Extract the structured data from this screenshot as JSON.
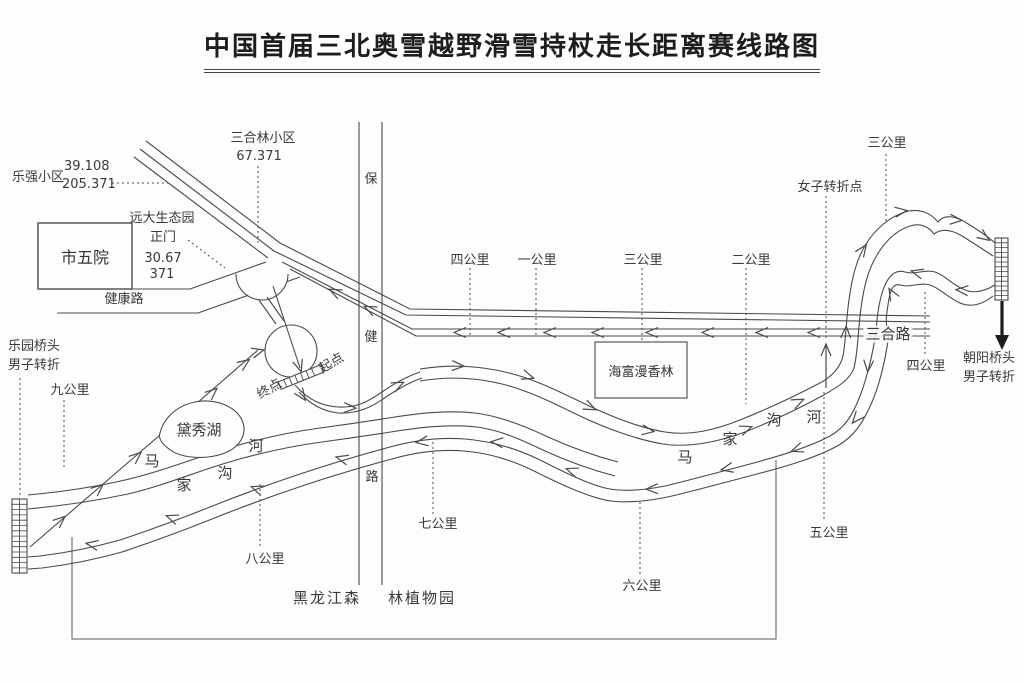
{
  "title": "中国首届三北奥雪越野滑雪持杖走长距离赛线路图",
  "labels": {
    "leqiang_name": "乐强小区",
    "leqiang_num1": "39.108",
    "leqiang_num2": "205.371",
    "sanhelin_name": "三合林小区",
    "sanhelin_num": "67.371",
    "yuanda_line1": "远大生态园",
    "yuanda_line2": "正门",
    "yuanda_num1": "30.67",
    "yuanda_num2": "371",
    "shiwuyuan": "市五院",
    "jiankang_road": "健康路",
    "baojian_bao": "保",
    "baojian_jian": "健",
    "baojian_lu": "路",
    "km4_top": "四公里",
    "km1_top": "一公里",
    "km3_top": "三公里",
    "km2_top": "二公里",
    "haifu": "海富漫香林",
    "nvzi_turn": "女子转折点",
    "km3_right": "三公里",
    "sanhe_road": "三合路",
    "km4_right": "四公里",
    "chaoyang_line1": "朝阳桥头",
    "chaoyang_line2": "男子转折",
    "leyuan_line1": "乐园桥头",
    "leyuan_line2": "男子转折",
    "km9": "九公里",
    "daixiu_lake": "黛秀湖",
    "river_left_1": "马",
    "river_left_2": "家",
    "river_left_3": "沟",
    "river_left_4": "河",
    "river_right_1": "马",
    "river_right_2": "家",
    "river_right_3": "沟",
    "river_right_4": "河",
    "km8": "八公里",
    "km7": "七公里",
    "km6": "六公里",
    "km5": "五公里",
    "heilongjiang_left": "黑龙江森",
    "heilongjiang_right": "林植物园",
    "qidian": "起点",
    "zhongdian": "终点"
  },
  "colors": {
    "line": "#4a4a4a",
    "text": "#333333",
    "background": "#fdfdfc"
  }
}
